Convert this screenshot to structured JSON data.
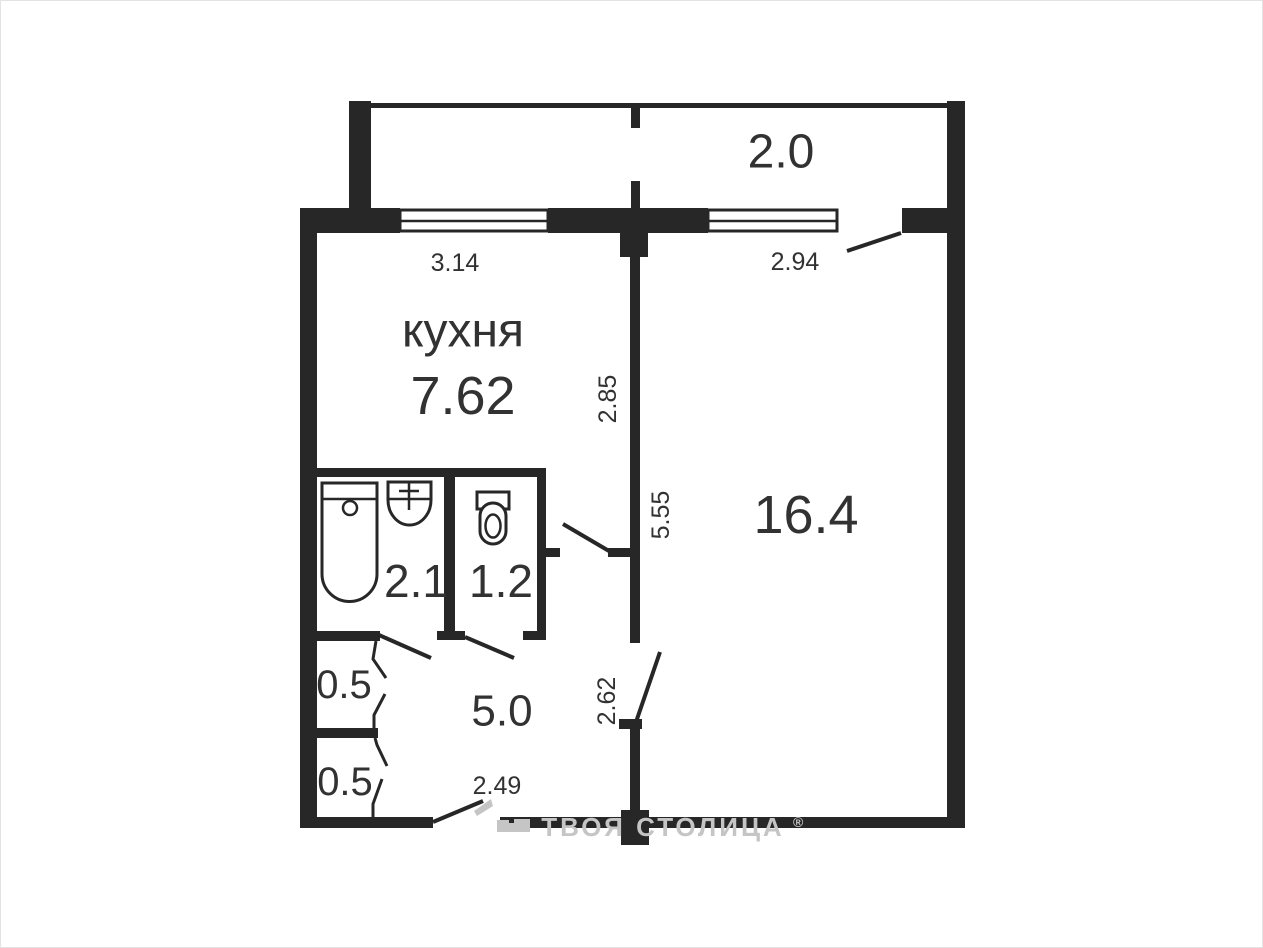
{
  "floorplan": {
    "rooms": {
      "balcony_area": "2.0",
      "kitchen_name": "кухня",
      "kitchen_area": "7.62",
      "living_area": "16.4",
      "bath_area": "2.1",
      "wc_area": "1.2",
      "hall_area": "5.0",
      "closet_top_area": "0.5",
      "closet_bottom_area": "0.5"
    },
    "dims": {
      "kitchen_window": "3.14",
      "living_window": "2.94",
      "kitchen_depth": "2.85",
      "living_depth": "5.55",
      "living_lower": "2.62",
      "hall_width": "2.49"
    },
    "watermark": {
      "brand": "ТВОЯ СТОЛИЦА",
      "reg": "®"
    },
    "colors": {
      "wall": "#272727",
      "label": "#323232",
      "watermark": "#c5c5c5",
      "background": "#ffffff"
    }
  }
}
